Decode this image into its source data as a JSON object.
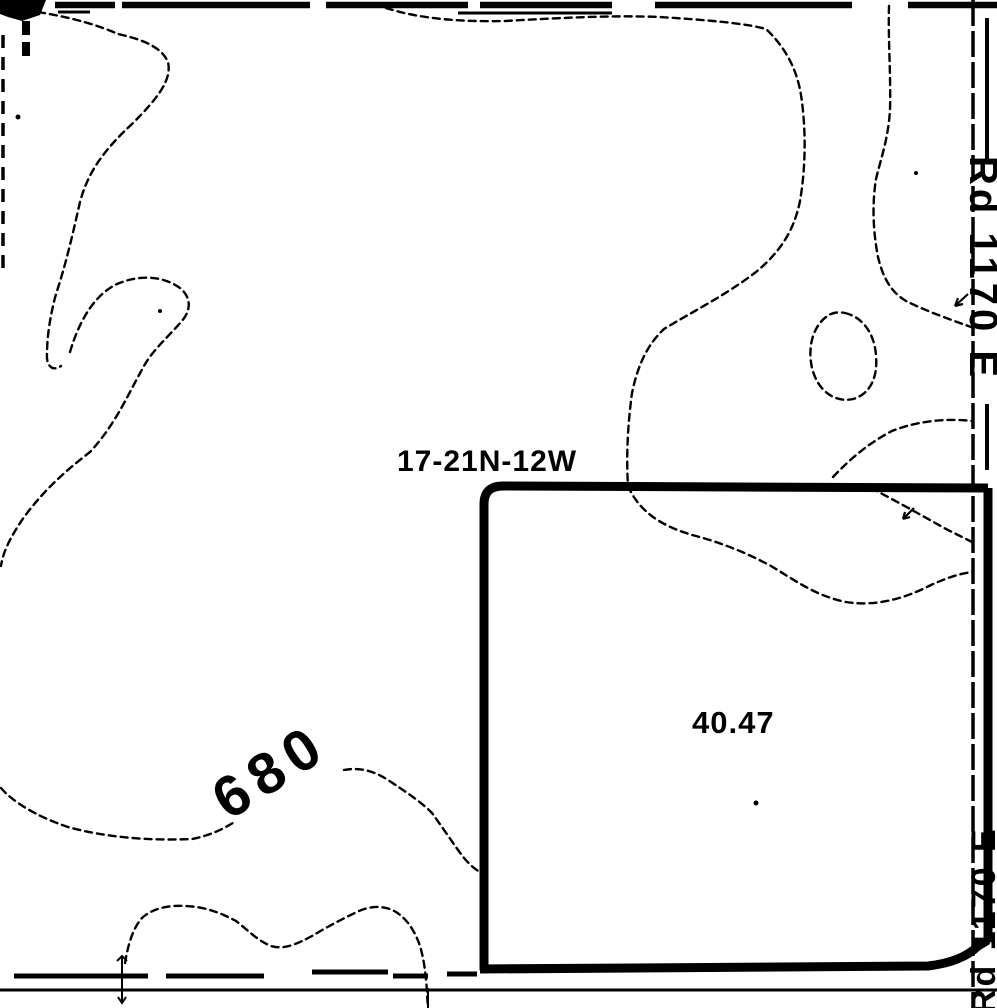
{
  "labels": {
    "section_township_range": "17-21N-12W",
    "parcel_acreage": "40.47",
    "contour_elevation": "680",
    "road_east_top": "Rd 1170 E",
    "road_east_bottom": "Rd 1170 E"
  },
  "colors": {
    "ink": "#000000",
    "paper": "#ffffff"
  }
}
